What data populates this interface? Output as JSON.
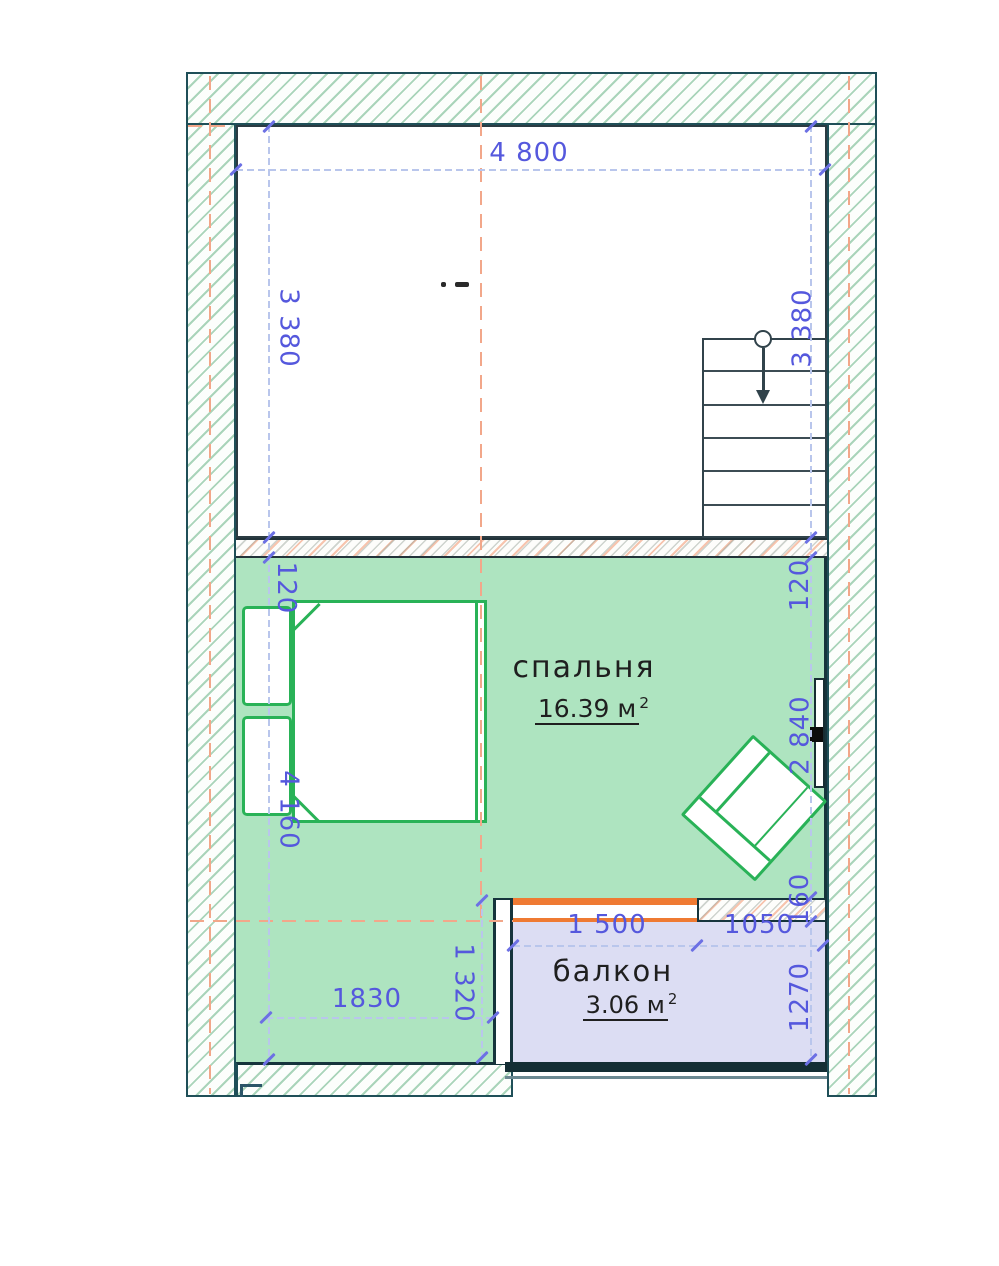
{
  "plan": {
    "rooms": {
      "bedroom": {
        "name": "спальня",
        "area_label": "16.39 м",
        "area_sup": "2",
        "fill": "#aee4c0"
      },
      "balcony": {
        "name": "балкон",
        "area_label": "3.06 м",
        "area_sup": "2",
        "fill": "#dcddf3"
      }
    },
    "dim_labels": {
      "top_width": "4 800",
      "upper_left_height": "3 380",
      "upper_right_height": "3 380",
      "wall_left": "120",
      "wall_right": "120",
      "bedroom_left_height": "4 160",
      "bedroom_right_height": "2 840",
      "balcony_wall": "160",
      "balcony_height": "1270",
      "window_width": "1 500",
      "pier_width": "1050",
      "lower_width": "1830",
      "lower_height": "1 320"
    },
    "colors": {
      "wall_outline": "#1f4f58",
      "room_outline": "#2b3b42",
      "furniture_green": "#29b257",
      "bedroom_fill": "#aee4c0",
      "balcony_fill": "#dcddf3",
      "dimension_blue": "#5558dd",
      "axis_orange": "#f2a78a",
      "window_orange": "#ef7a33"
    }
  }
}
